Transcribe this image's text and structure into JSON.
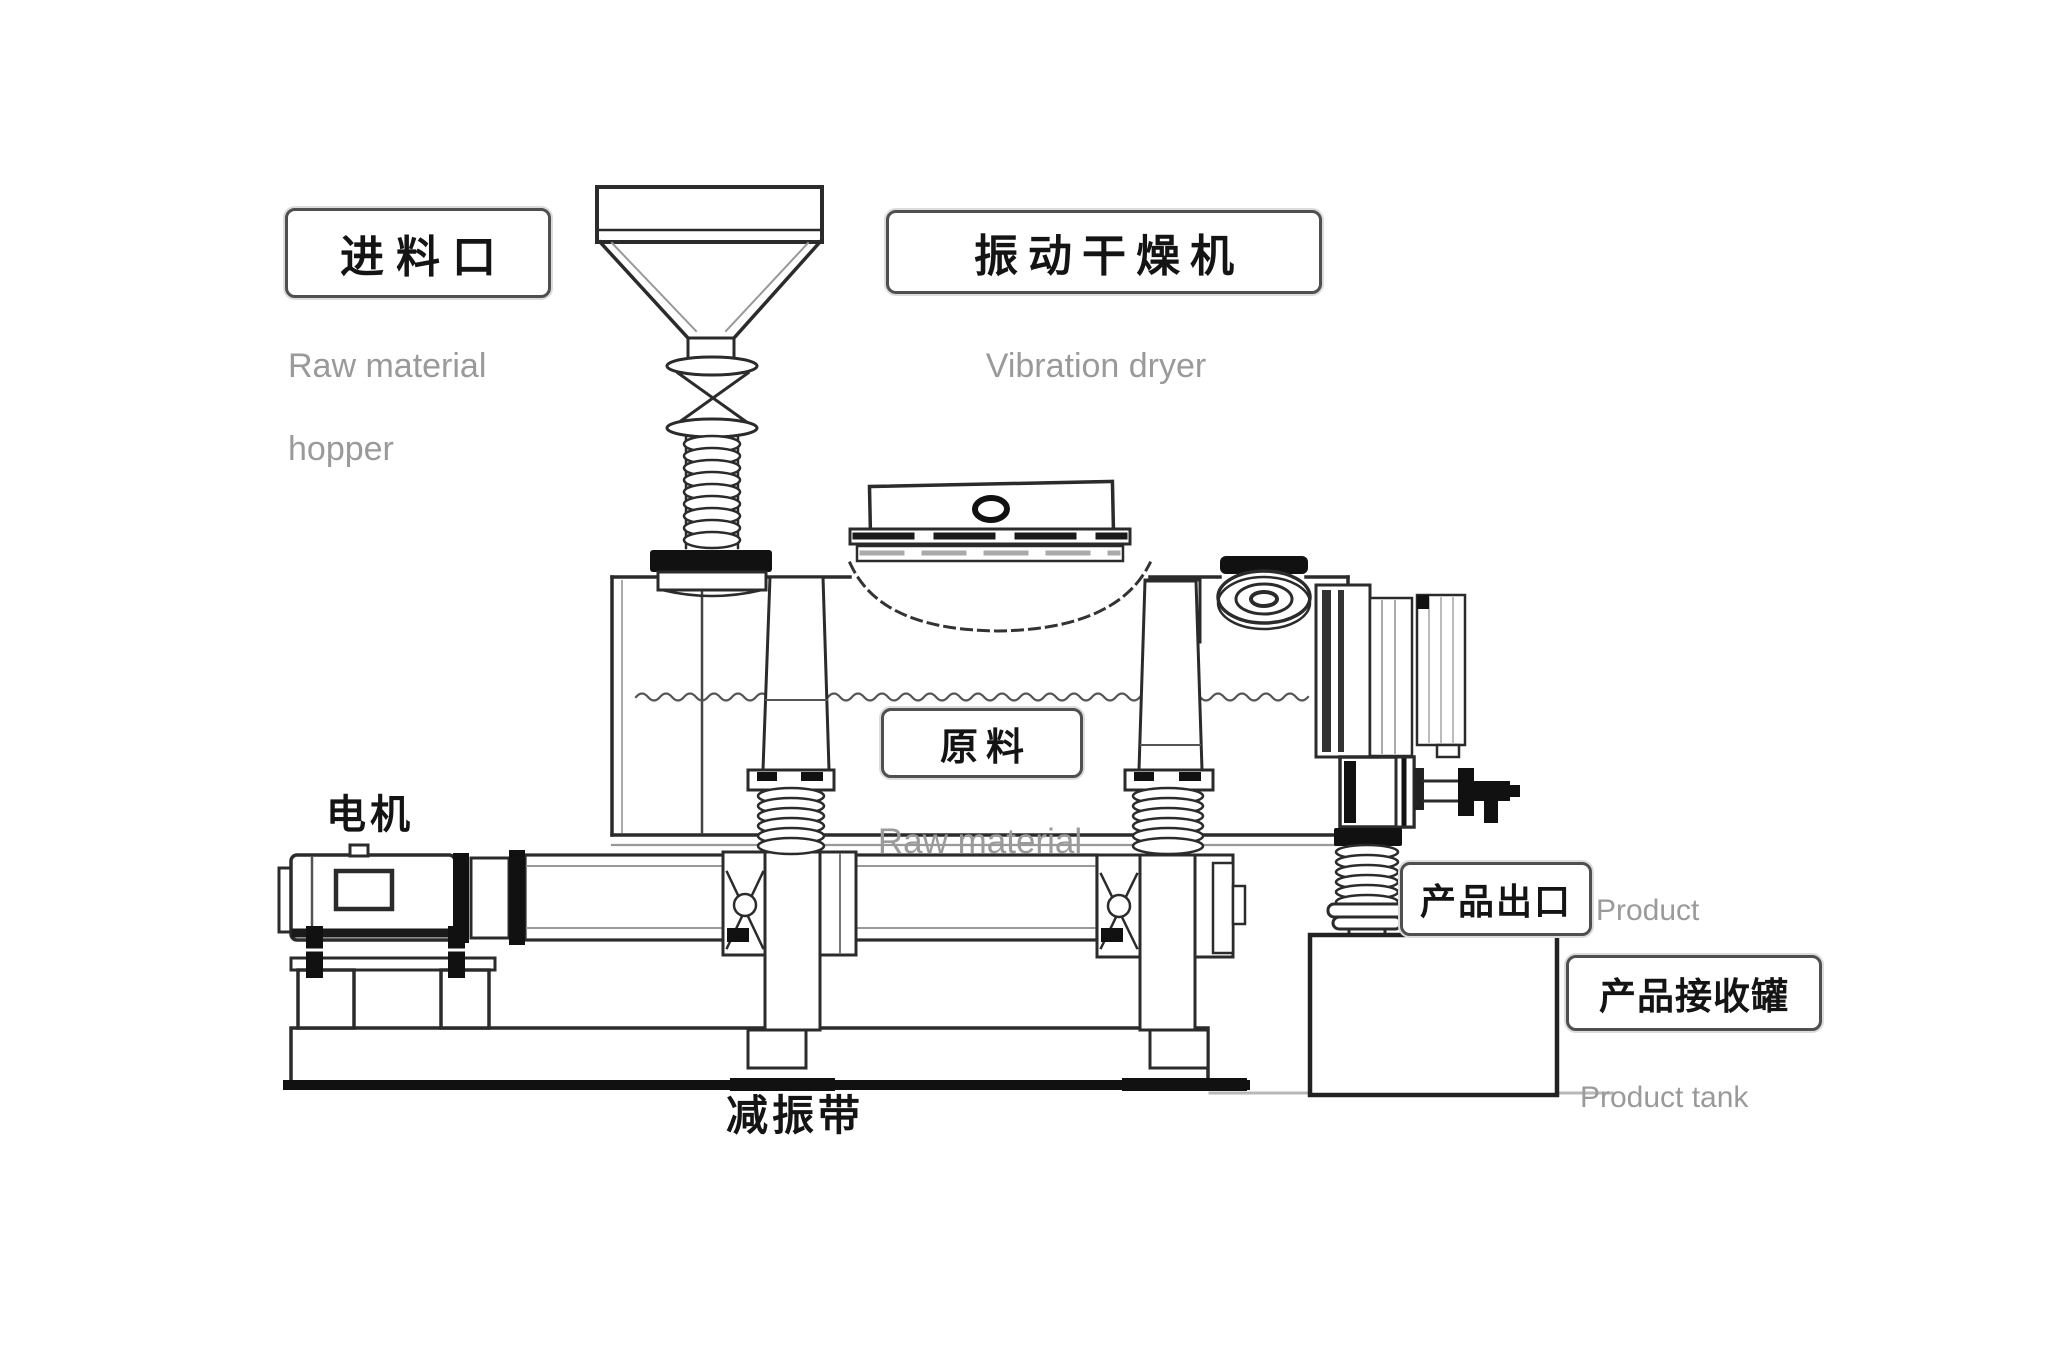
{
  "page": {
    "background": "#ffffff"
  },
  "labels": {
    "feed_inlet": {
      "zh": "进料口",
      "en_line1": "Raw material",
      "en_line2": "hopper"
    },
    "vibration_dryer": {
      "zh": "振动干燥机",
      "en": "Vibration dryer"
    },
    "raw_material": {
      "zh": "原料",
      "en": "Raw material"
    },
    "motor": {
      "zh": "电机"
    },
    "damping_band": {
      "zh": "减振带"
    },
    "product_discharge_port": {
      "zh": "产品出口",
      "en_line1": "Product",
      "en_line2": "discharge port"
    },
    "product_tank": {
      "zh": "产品接收罐",
      "en": "Product tank"
    }
  },
  "colors": {
    "line": "#2b2b2b",
    "dark_fill": "#111111",
    "label_text": "#141414",
    "english_text": "#9a9a9a",
    "box_border": "#4f4f4f",
    "background": "#ffffff"
  }
}
